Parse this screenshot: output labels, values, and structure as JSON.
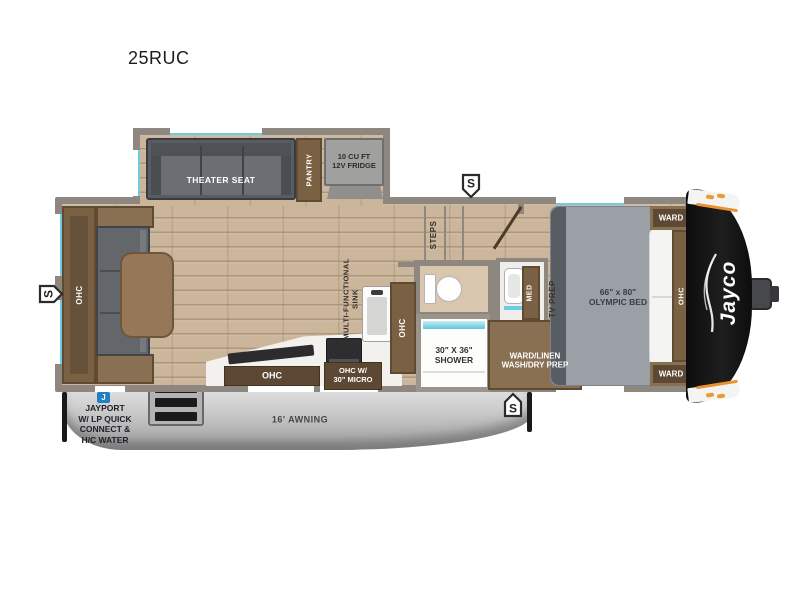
{
  "model": "25RUC",
  "brand": {
    "logo": "Jayco"
  },
  "badges": {
    "speaker": "S",
    "jayport": "J"
  },
  "slideout": {
    "theater_seat": "THEATER SEAT",
    "pantry": "PANTRY",
    "fridge": "10 CU FT\n12V FRIDGE"
  },
  "living": {
    "ohc": "OHC"
  },
  "kitchen": {
    "sink": "MULTI-FUNCTIONAL\nSINK",
    "ohc": "OHC",
    "ohc_micro": "OHC W/\n30\" MICRO",
    "ohc_tall": "OHC",
    "steps": "STEPS"
  },
  "bath": {
    "shower": "30\" X 36\"\nSHOWER",
    "med": "MED",
    "ward_linen": "WARD/LINEN\nWASH/DRY PREP"
  },
  "bedroom": {
    "bed": "66\" x 80\"\nOLYMPIC BED",
    "tv_prep": "TV PREP",
    "ward_top": "WARD",
    "ward_bottom": "WARD",
    "ohc": "OHC"
  },
  "exterior": {
    "awning": "16' AWNING",
    "jayport": "JAYPORT\nW/ LP QUICK\nCONNECT &\nH/C WATER"
  },
  "colors": {
    "accent_teal": "#6fcbe0",
    "jayport_blue": "#1f80c2",
    "marker_orange": "#ef9a2e",
    "cabinet_brown": "#7b6143",
    "wall_gray": "#8d8780"
  }
}
